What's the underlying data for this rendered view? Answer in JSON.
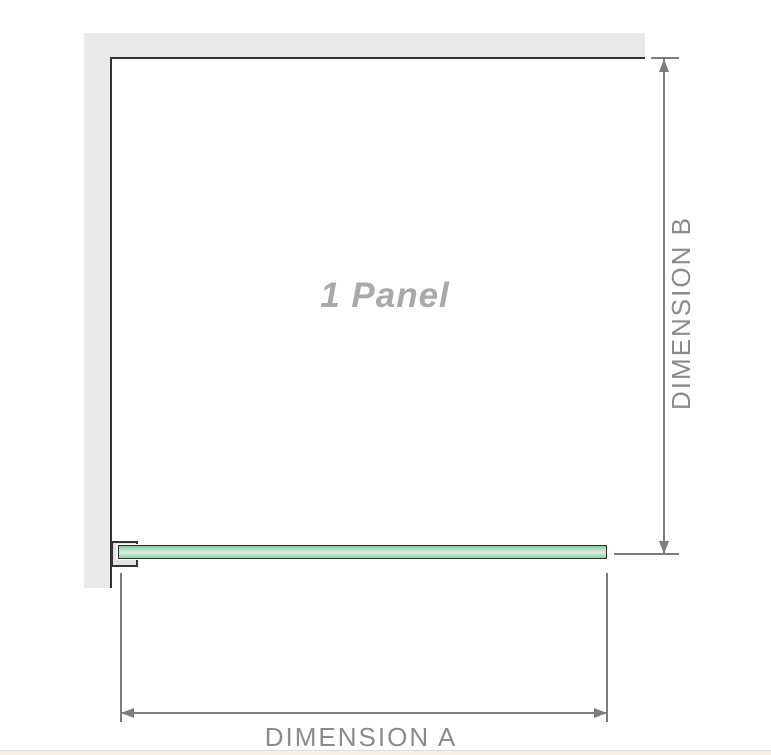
{
  "labels": {
    "panel": "1 Panel",
    "dimension_a": "DIMENSION A",
    "dimension_b": "DIMENSION B"
  },
  "colors": {
    "wall_fill": "#e9e9e9",
    "wall_edge": "#333333",
    "dimension_line": "#7d7d7d",
    "dimension_text": "#8b8b8b",
    "panel_text": "#a9a9a9",
    "glass_border": "#2f2f2f",
    "glass_green_dark": "#85caa4",
    "glass_green_light": "#dcefe2",
    "bracket_fill": "#e3e3e3",
    "footer_strip": "#f4f0e7"
  }
}
